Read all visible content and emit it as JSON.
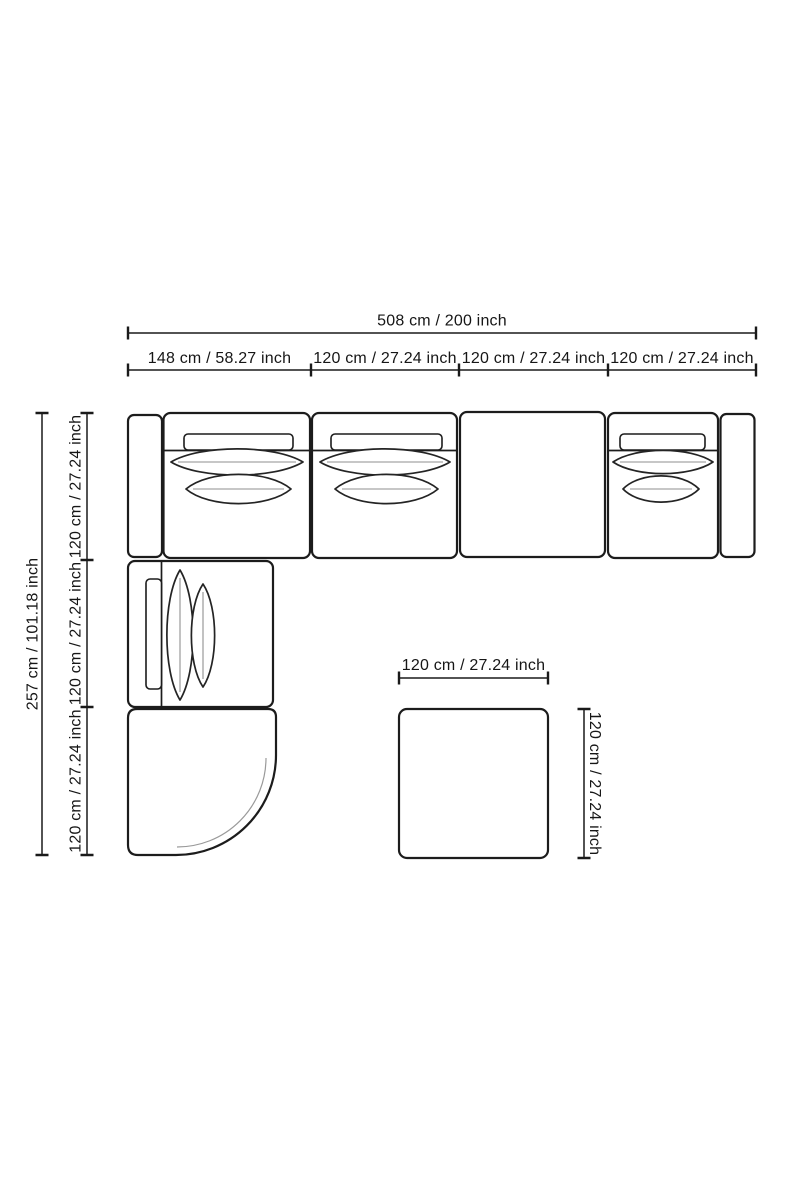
{
  "canvas": {
    "background": "#ffffff",
    "line_color": "#1c1c1c",
    "text_color": "#161616"
  },
  "dimensions": {
    "sofa_total_width": "508 cm / 200 inch",
    "sofa_top_segments": [
      "148 cm / 58.27 inch",
      "120 cm / 27.24 inch",
      "120 cm / 27.24 inch",
      "120 cm / 27.24 inch"
    ],
    "sofa_total_depth": "257 cm / 101.18 inch",
    "sofa_left_segments": [
      "120 cm / 27.24 inch",
      "120 cm / 27.24 inch",
      "120 cm / 27.24 inch"
    ],
    "ottoman_width": "120 cm / 27.24 inch",
    "ottoman_depth": "120 cm / 27.24 inch"
  }
}
